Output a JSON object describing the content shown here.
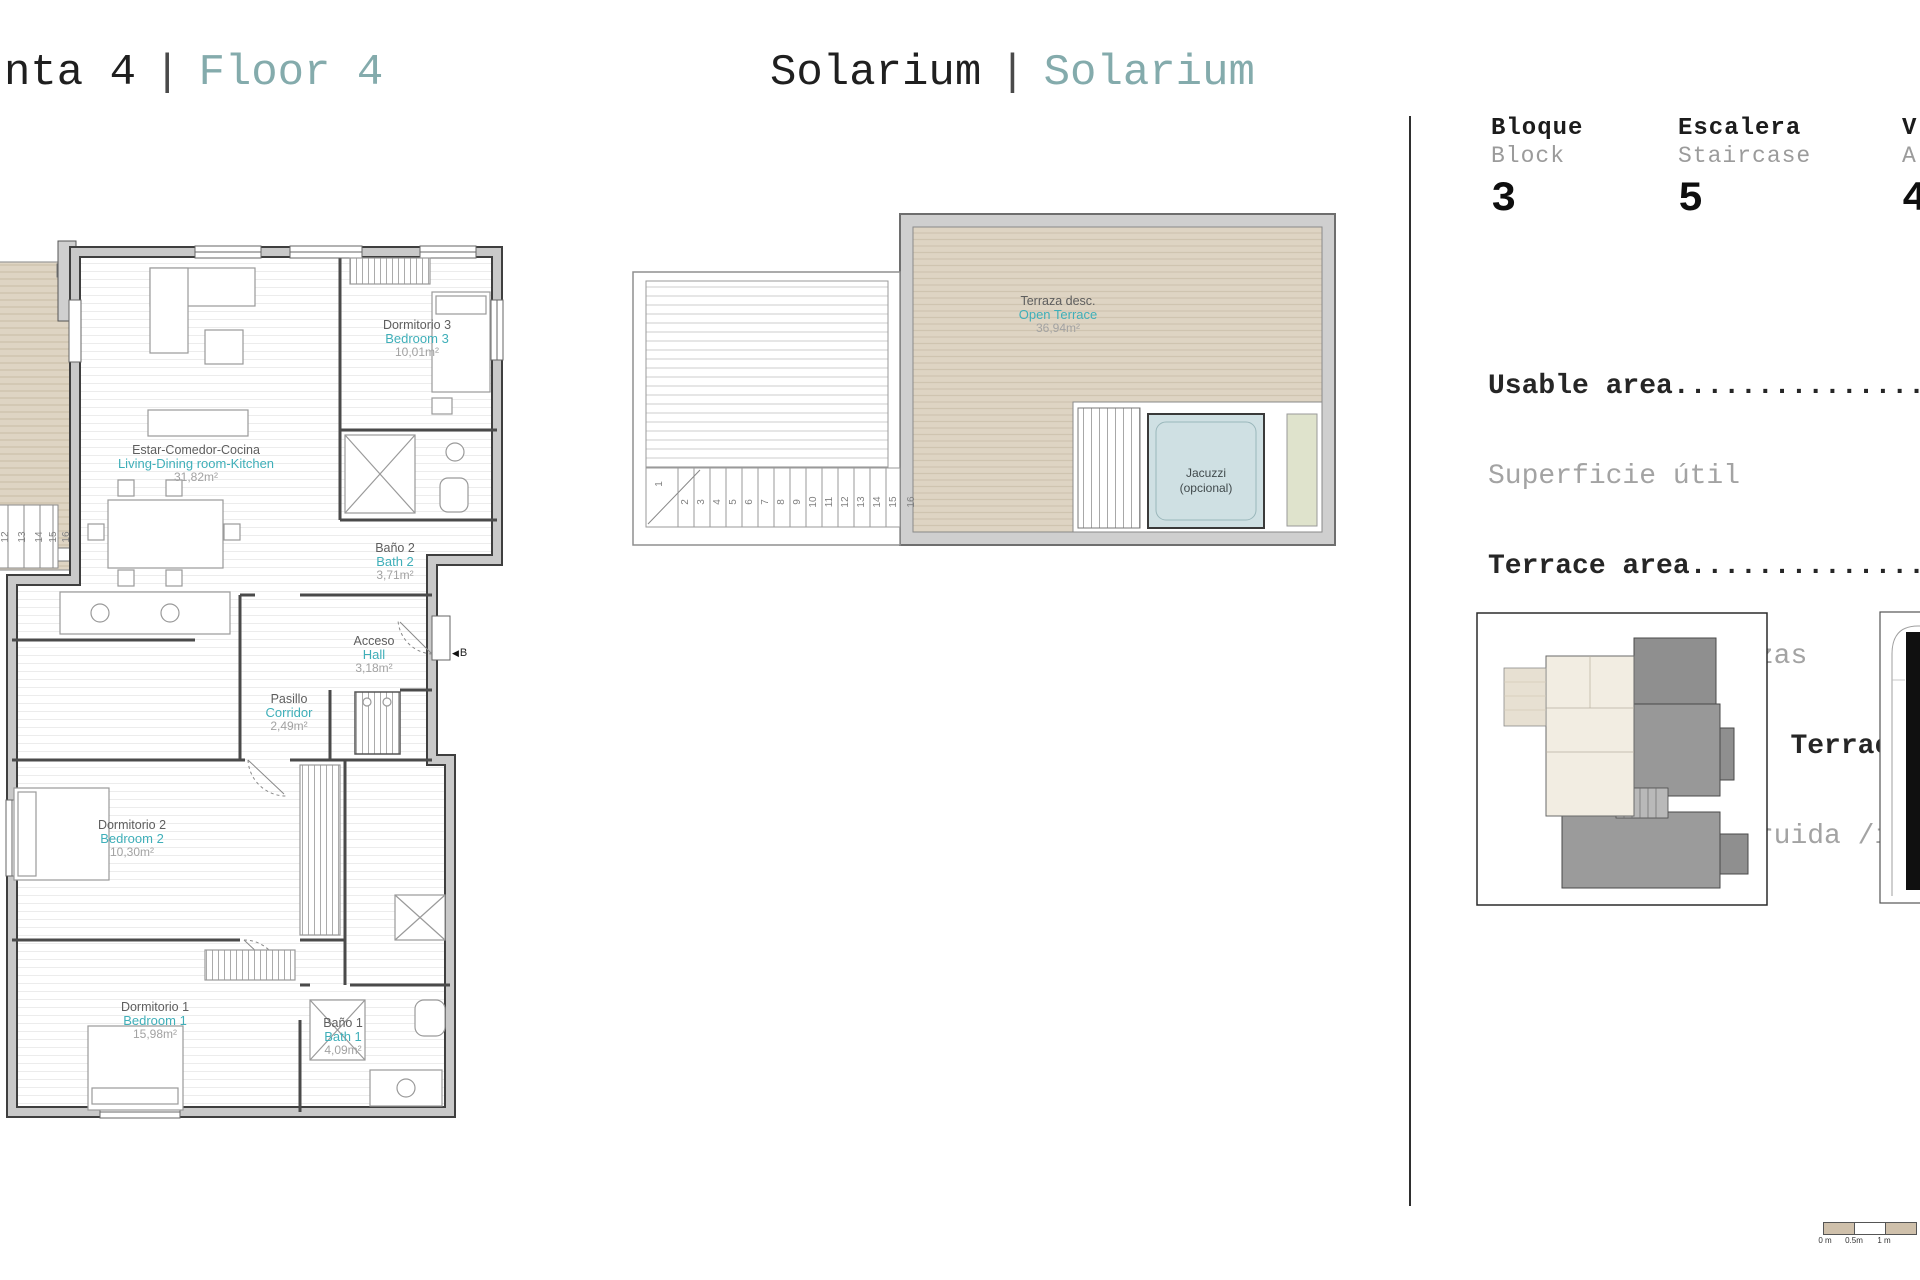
{
  "titles": {
    "left": {
      "main": "nta 4",
      "sep": "|",
      "alt": "Floor 4"
    },
    "center": {
      "main": "Solarium",
      "sep": "|",
      "alt": "Solarium"
    }
  },
  "info": {
    "columns": [
      {
        "es": "Bloque",
        "en": "Block",
        "value": "3"
      },
      {
        "es": "Escalera",
        "en": "Staircase",
        "value": "5"
      },
      {
        "es": "V",
        "en": "A",
        "value": "4"
      }
    ],
    "areas": [
      {
        "en": "Usable area..............................",
        "es": "Superficie útil"
      },
      {
        "en": "Terrace area.............................",
        "es": "Superficie terrazas"
      },
      {
        "en": "Built area /Incl. Terrace/ ..............",
        "es": "Superficie construida /incl. ......"
      }
    ]
  },
  "floor_plan": {
    "rooms": [
      {
        "es": "Dormitorio 3",
        "en": "Bedroom 3",
        "area": "10,01m²"
      },
      {
        "es": "Estar-Comedor-Cocina",
        "en": "Living-Dining room-Kitchen",
        "area": "31,82m²"
      },
      {
        "es": "Baño 2",
        "en": "Bath 2",
        "area": "3,71m²"
      },
      {
        "es": "Acceso",
        "en": "Hall",
        "area": "3,18m²"
      },
      {
        "es": "Pasillo",
        "en": "Corridor",
        "area": "2,49m²"
      },
      {
        "es": "Dormitorio 2",
        "en": "Bedroom 2",
        "area": "10,30m²"
      },
      {
        "es": "Dormitorio 1",
        "en": "Bedroom 1",
        "area": "15,98m²"
      },
      {
        "es": "Baño 1",
        "en": "Bath 1",
        "area": "4,09m²"
      }
    ],
    "entry": "B",
    "stairs": [
      "12",
      "13",
      "14",
      "15",
      "16"
    ]
  },
  "solarium": {
    "terrace": {
      "es": "Terraza desc.",
      "en": "Open Terrace",
      "area": "36,94m²"
    },
    "jacuzzi": {
      "line1": "Jacuzzi",
      "line2": "(opcional)"
    },
    "stairs": [
      "1",
      "2",
      "3",
      "4",
      "5",
      "6",
      "7",
      "8",
      "9",
      "10",
      "11",
      "12",
      "13",
      "14",
      "15",
      "16"
    ]
  },
  "scale": {
    "labels": [
      "0 m",
      "0.5m",
      "1 m"
    ]
  },
  "colors": {
    "accent_teal": "#3FAFB9",
    "title_teal": "#84ABAC",
    "deck_beige": "#DED4C3",
    "jacuzzi_blue": "#CFE0E3"
  }
}
